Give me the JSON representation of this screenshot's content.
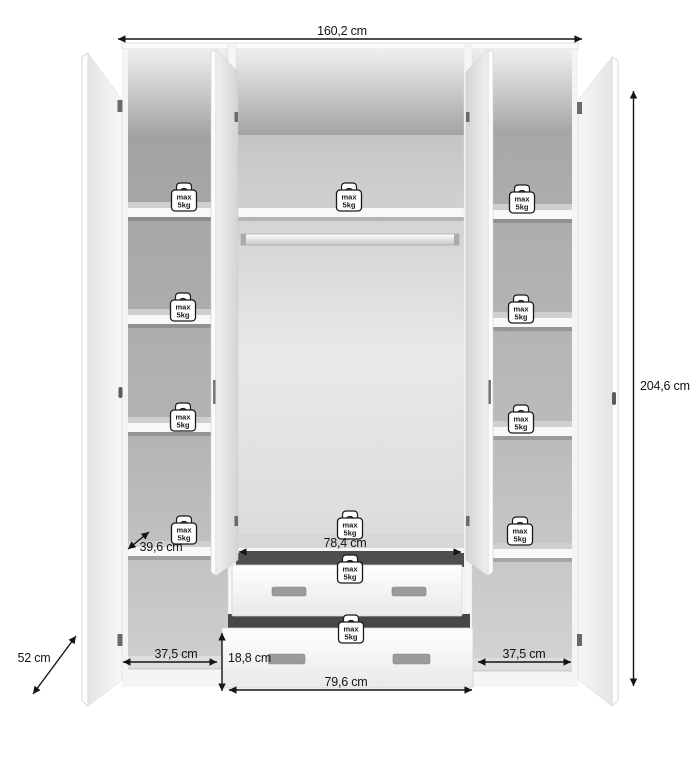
{
  "dimensions": {
    "total_width": "160,2 cm",
    "total_height": "204,6 cm",
    "total_depth": "52 cm",
    "shelf_depth": "39,6 cm",
    "middle_interior_width": "78,4 cm",
    "left_interior_width": "37,5 cm",
    "right_interior_width": "37,5 cm",
    "drawer_front_height": "18,8 cm",
    "drawer_bottom_width": "79,6 cm"
  },
  "weight_badge": {
    "line1": "max",
    "line2": "5kg"
  },
  "colors": {
    "dimension_line": "#141414",
    "badge_outline": "#1a1a1a",
    "carcass_white": "#f5f5f5",
    "interior_gray": "#adadad",
    "drawer_gap_dark": "#4a4a4a",
    "handle_gray": "#9b9b9b"
  }
}
